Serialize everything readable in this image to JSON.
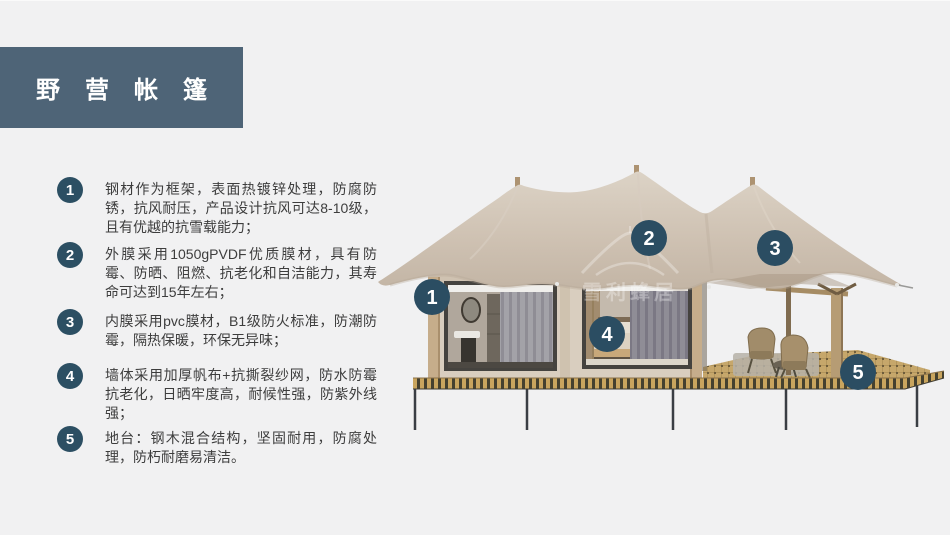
{
  "title": {
    "text": "野营帐篷"
  },
  "features": [
    {
      "num": "1",
      "text": "钢材作为框架，表面热镀锌处理，防腐防锈，抗风耐压，产品设计抗风可达8-10级，且有优越的抗雪载能力；"
    },
    {
      "num": "2",
      "text": "外膜采用1050gPVDF优质膜材，具有防霉、防晒、阻燃、抗老化和自洁能力，其寿命可达到15年左右；"
    },
    {
      "num": "3",
      "text": "内膜采用pvc膜材，B1级防火标准，防潮防霉，隔热保暖，环保无异味；"
    },
    {
      "num": "4",
      "text": "墙体采用加厚帆布+抗撕裂纱网，防水防霉抗老化，日晒牢度高，耐候性强，防紫外线强；"
    },
    {
      "num": "5",
      "text": "地台：钢木混合结构，坚固耐用，防腐处理，防朽耐磨易清洁。"
    }
  ],
  "diagram": {
    "watermark": {
      "text": "雪利蜂居"
    },
    "callouts": [
      {
        "num": "1"
      },
      {
        "num": "2"
      },
      {
        "num": "3"
      },
      {
        "num": "4"
      },
      {
        "num": "5"
      }
    ]
  },
  "colors": {
    "background": "#f1f1f2",
    "title_block": "#4e6477",
    "badge": "#2c4f63",
    "body_text": "#3d3d3d",
    "roof_fabric": "#cdc0b1",
    "cabin_wall": "#d9cebf",
    "deck": "#c6a76b",
    "platform_stripe": "#c9a55e",
    "legs": "#3a3e44"
  }
}
